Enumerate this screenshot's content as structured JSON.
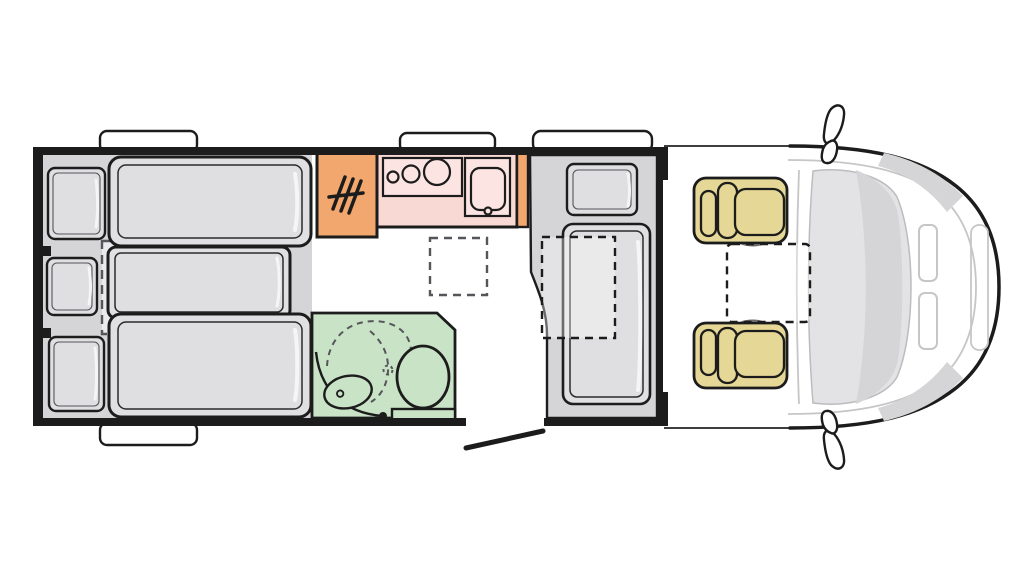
{
  "diagram": {
    "kind": "motorhome-floorplan",
    "view": "top-down",
    "orientation": "driver cab on the right, rear bedroom on the left",
    "zones": [
      {
        "id": "rear-bedroom",
        "items": [
          "single-bed-top",
          "single-bed-bottom",
          "middle-bed-extension",
          "pillow-top",
          "pillow-middle",
          "pillow-bottom"
        ]
      },
      {
        "id": "wardrobe",
        "items": [
          "hanger-symbol"
        ]
      },
      {
        "id": "kitchen",
        "items": [
          "worktop",
          "hob-3-burners",
          "sink",
          "faucet"
        ]
      },
      {
        "id": "bathroom",
        "items": [
          "washbasin",
          "toilet",
          "shower-swing-arcs",
          "door-pivot"
        ]
      },
      {
        "id": "entrance-lounge",
        "items": [
          "single-bed",
          "pillow",
          "folding-table"
        ]
      },
      {
        "id": "entrance-door",
        "items": [
          "door-swing-line"
        ]
      },
      {
        "id": "cab",
        "items": [
          "driver-seat",
          "passenger-seat",
          "swivel-table-zone",
          "windshield",
          "hood",
          "headlight-left",
          "headlight-right",
          "mirror-top",
          "mirror-bottom"
        ]
      },
      {
        "id": "roof-windows",
        "items": [
          "window-rear-top",
          "window-kitchen-top",
          "window-entry-top",
          "window-rear-bottom"
        ]
      }
    ]
  },
  "colors": {
    "wall": "#1c1c1c",
    "floor": "#d5d5d7",
    "bedOuter": "#e0e0e2",
    "mattress": "#dfdfe1",
    "extension": "#eaeaec",
    "highlight": "#f5f5f7",
    "wardrobe": "#f1a76e",
    "counter": "#f9d9d4",
    "counterPanel": "#fbe4e1",
    "bathroom": "#c9e3c7",
    "seat": "#e5d795",
    "glass": "#e3e3e5",
    "glassShade": "#d5d5d7",
    "bodyLine": "#c6c6c8",
    "dashLine": "#55555a",
    "windowFill": "#ffffff"
  }
}
